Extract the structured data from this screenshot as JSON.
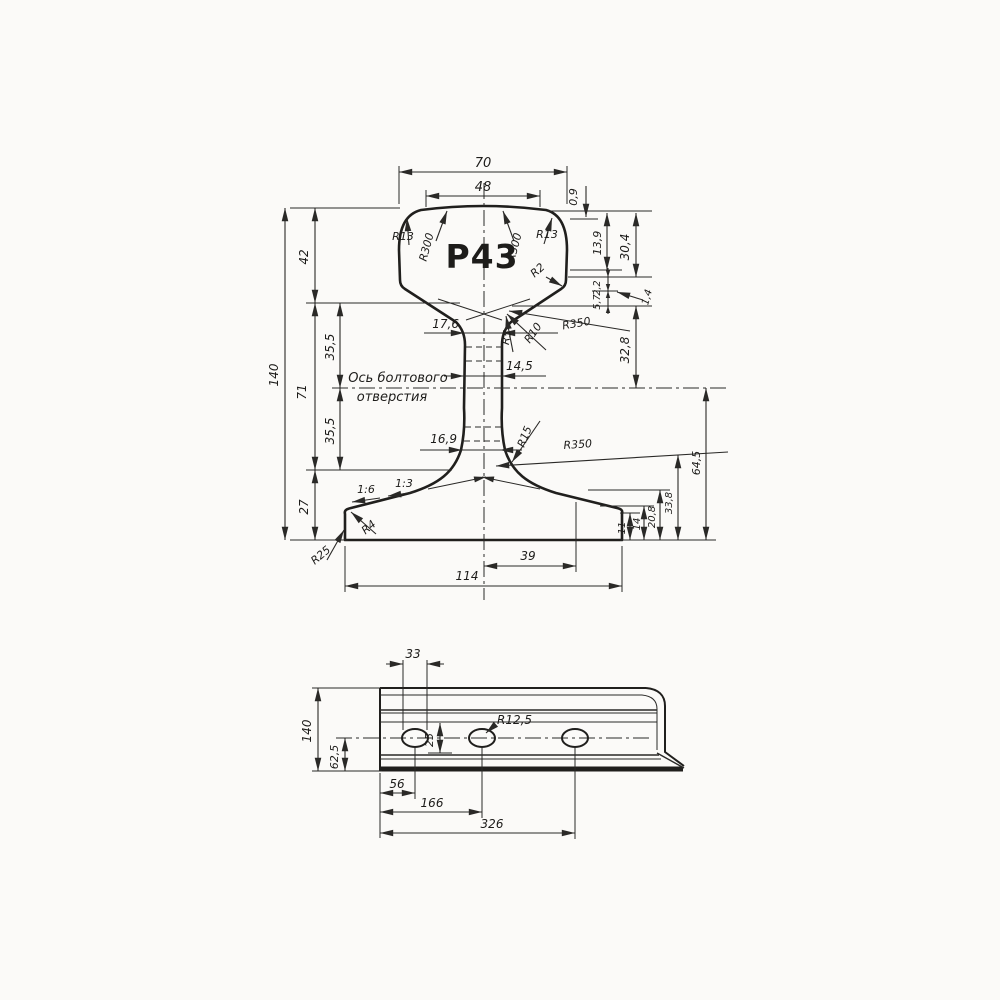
{
  "app": {
    "background": "#fbfaf8",
    "ink": "#201f1d",
    "title": "P43 rail drawing"
  },
  "cs": {
    "label": "P43",
    "d70": "70",
    "d48": "48",
    "d09": "0,9",
    "d139": "13,9",
    "d304": "30,4",
    "r13l": "R13",
    "r300l": "R300",
    "r300r": "R300",
    "r13r": "R13",
    "r2": "R2",
    "d22": "2,2",
    "d57": "5,7",
    "d14s": "1,4",
    "d42": "42",
    "d140": "140",
    "d71": "71",
    "d355a": "35,5",
    "d355b": "35,5",
    "d27": "27",
    "d176": "17,6",
    "r5": "R5",
    "r10": "R10",
    "r350u": "R350",
    "d328": "32,8",
    "d145": "14,5",
    "axis1": "Ось болтового",
    "axis2": "отверстия",
    "d169": "16,9",
    "r15": "R15",
    "r350l": "R350",
    "s16": "1:6",
    "s13": "1:3",
    "r4": "R4",
    "r25": "R25",
    "d11": "11",
    "d14": "14",
    "d208": "20,8",
    "d338": "33,8",
    "d645": "64,5",
    "d39": "39",
    "d114": "114"
  },
  "sv": {
    "d33": "33",
    "d140": "140",
    "d625": "62,5",
    "d25": "25",
    "r125": "R12,5",
    "d56": "56",
    "d166": "166",
    "d326": "326"
  }
}
